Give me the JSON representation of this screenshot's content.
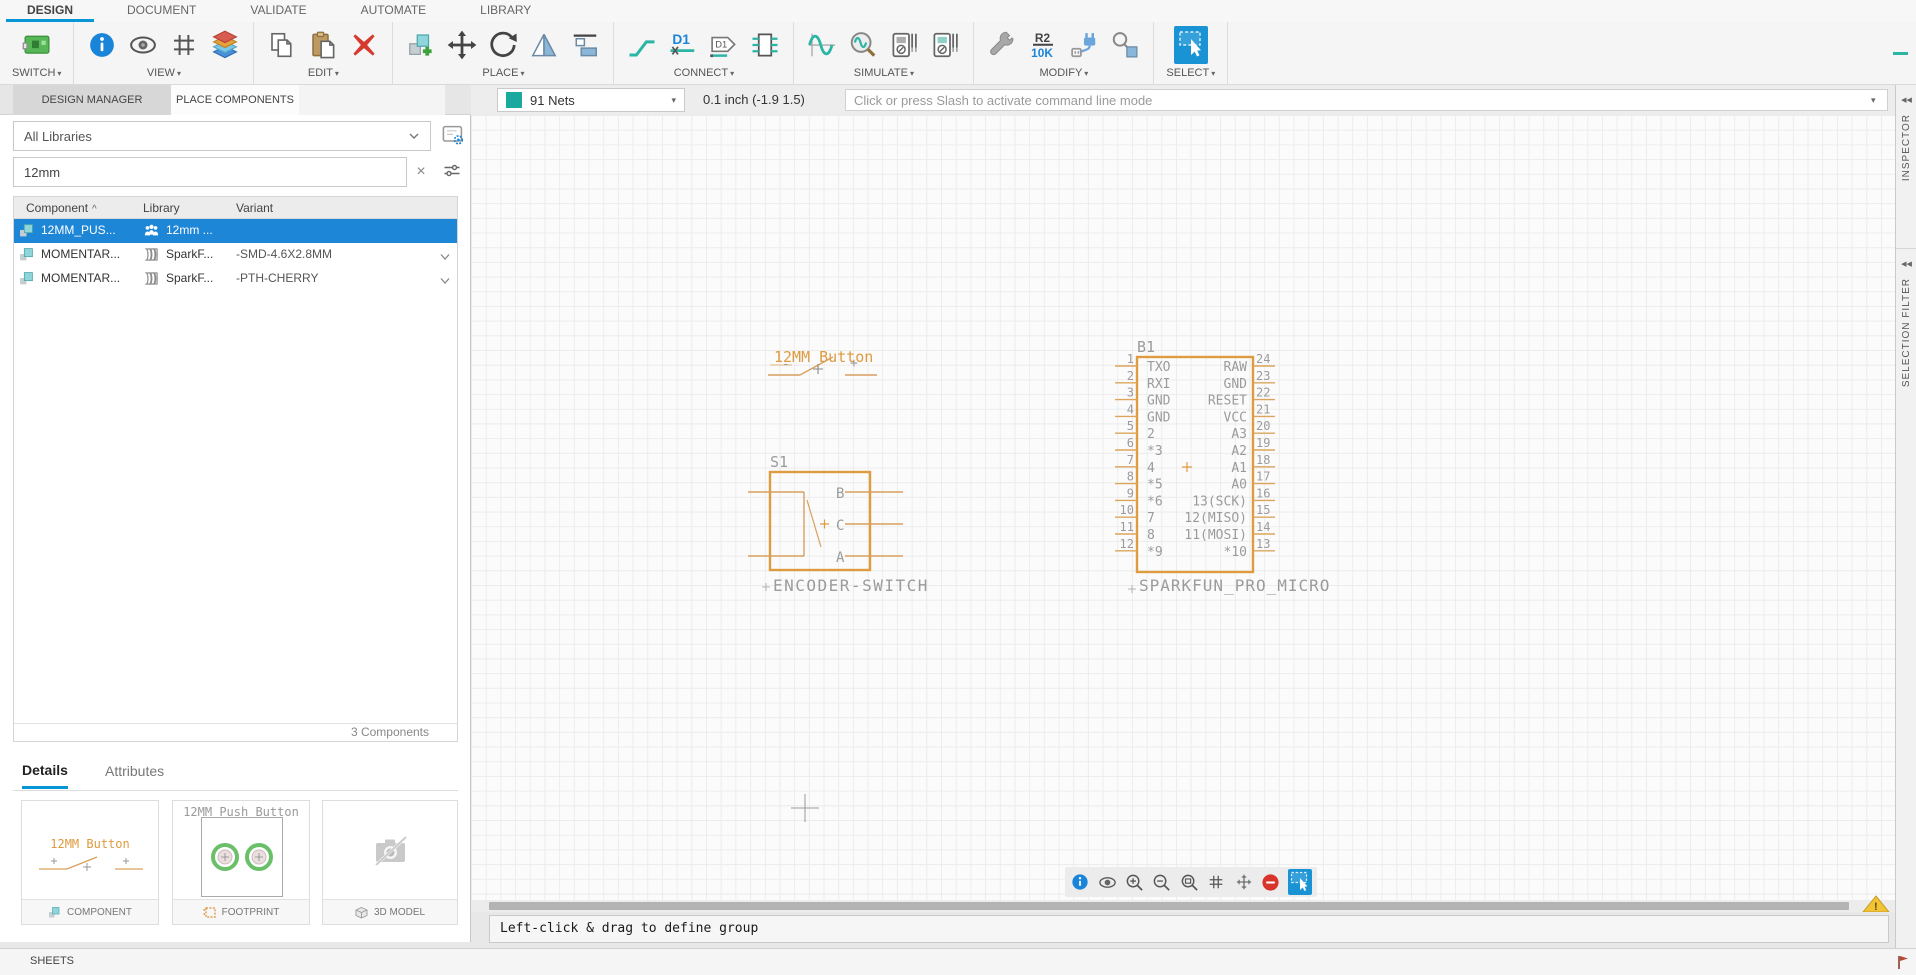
{
  "colors": {
    "accent": "#0696d7",
    "selection_blue": "#1e86d6",
    "net_teal": "#1ba89f",
    "schematic_orange": "#e09a40",
    "schematic_gray": "#9b9b9b",
    "delete_red": "#d9342b",
    "warning_yellow": "#f2c335"
  },
  "menubar": {
    "tabs": [
      {
        "label": "DESIGN",
        "active": true
      },
      {
        "label": "DOCUMENT",
        "active": false
      },
      {
        "label": "VALIDATE",
        "active": false
      },
      {
        "label": "AUTOMATE",
        "active": false
      },
      {
        "label": "LIBRARY",
        "active": false
      }
    ]
  },
  "toolbar": {
    "caret": "▾",
    "groups": [
      {
        "label": "SWITCH"
      },
      {
        "label": "VIEW"
      },
      {
        "label": "EDIT"
      },
      {
        "label": "PLACE"
      },
      {
        "label": "CONNECT"
      },
      {
        "label": "SIMULATE"
      },
      {
        "label": "MODIFY"
      },
      {
        "label": "SELECT"
      }
    ],
    "icon_text": {
      "net_label": "D1",
      "name_tag": "D1",
      "value_ref": "R2",
      "value_val": "10K"
    }
  },
  "panel_tabs": {
    "design_manager": "DESIGN MANAGER",
    "place_components": "PLACE COMPONENTS"
  },
  "canvas_bar": {
    "nets_label": "91 Nets",
    "grid_coords": "0.1 inch (-1.9 1.5)",
    "command_placeholder": "Click or press Slash to activate command line mode",
    "caret": "▾"
  },
  "library_panel": {
    "library_filter": "All Libraries",
    "search_value": "12mm",
    "clear_glyph": "×",
    "table": {
      "sort_glyph": "^",
      "headers": [
        "Component",
        "Library",
        "Variant"
      ],
      "rows": [
        {
          "component": "12MM_PUS...",
          "library": "12mm ...",
          "variant": "",
          "selected": true,
          "expandable": false,
          "library_icon": "team"
        },
        {
          "component": "MOMENTAR...",
          "library": "SparkF...",
          "variant": "-SMD-4.6X2.8MM",
          "selected": false,
          "expandable": true,
          "library_icon": "managed"
        },
        {
          "component": "MOMENTAR...",
          "library": "SparkF...",
          "variant": "-PTH-CHERRY",
          "selected": false,
          "expandable": true,
          "library_icon": "managed"
        }
      ]
    },
    "count_label": "3 Components",
    "tabs": {
      "details": "Details",
      "attributes": "Attributes"
    },
    "cards": {
      "component": {
        "footer": "COMPONENT",
        "preview_title": "12MM Button"
      },
      "footprint": {
        "footer": "FOOTPRINT",
        "preview_title": "12MM Push Button"
      },
      "model3d": {
        "footer": "3D MODEL"
      }
    }
  },
  "schematic": {
    "button": {
      "label": "12MM Button",
      "minus": "-",
      "plus": "+"
    },
    "encoder": {
      "ref": "S1",
      "name": "ENCODER-SWITCH",
      "pins": [
        "B",
        "C",
        "A"
      ]
    },
    "micro": {
      "ref": "B1",
      "name": "SPARKFUN_PRO_MICRO",
      "left_numbers": [
        "1",
        "2",
        "3",
        "4",
        "5",
        "6",
        "7",
        "8",
        "9",
        "10",
        "11",
        "12"
      ],
      "left_names": [
        "TXO",
        "RXI",
        "GND",
        "GND",
        "2",
        "*3",
        "4",
        "*5",
        "*6",
        "7",
        "8",
        "*9"
      ],
      "right_names": [
        "RAW",
        "GND",
        "RESET",
        "VCC",
        "A3",
        "A2",
        "A1",
        "A0",
        "13(SCK)",
        "12(MISO)",
        "11(MOSI)",
        "*10"
      ],
      "right_numbers": [
        "24",
        "23",
        "22",
        "21",
        "20",
        "19",
        "18",
        "17",
        "16",
        "15",
        "14",
        "13"
      ]
    }
  },
  "status_bar": {
    "message": "Left-click & drag to define group"
  },
  "right_panel": {
    "collapse_glyph": "◀◀",
    "inspector": "INSPECTOR",
    "selection_filter": "SELECTION FILTER"
  },
  "bottom_bar": {
    "sheets": "SHEETS"
  },
  "warning": {
    "glyph": "!"
  }
}
